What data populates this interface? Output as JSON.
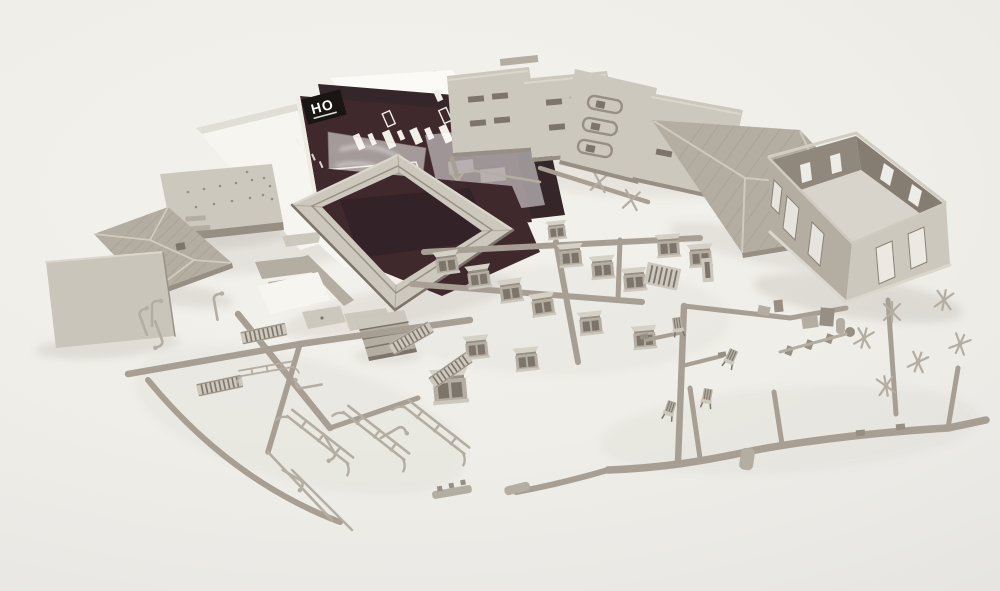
{
  "scene": {
    "type": "product photograph",
    "subject": "Unassembled HO scale model structure kit",
    "description": "Gray styrene plastic parts of an HO scale building kit laid out on a white seamless background: white instruction sheets, dark instruction booklet with HO logo, clear glazing sheet, bag of small parts, four fanned wall panels, large and small hip roof panels, an assembled four-wall building shell, foundation platform with steps, flat base plate, square roof trim frame, and sprues holding windows, doors, ladders, stairs, railings, lamp posts, chairs, chimneys and roof finial details."
  },
  "booklet": {
    "logo_text": "HO"
  },
  "colors": {
    "plastic_light": "#cdc8be",
    "plastic_mid": "#b4ada2",
    "plastic_dark": "#978f83",
    "plastic_deep": "#7d756b",
    "runner": "#a89f94",
    "paper_white": "#f6f5f0",
    "booklet_maroon": "#3f292c",
    "booklet_maroon_light": "#543a3e",
    "logo_black": "#181512",
    "background_top": "#f4f2ec",
    "background_bottom": "#e3e2df",
    "shadow": "#8a847a",
    "bag_amber": "#9b7c55"
  },
  "objects": [
    {
      "id": "paper-stack",
      "label": "White instruction sheets"
    },
    {
      "id": "instruction-booklet",
      "label": "Dark instruction booklet with HO logo and window diagrams"
    },
    {
      "id": "parts-bag",
      "label": "Clear polybag of small parts"
    },
    {
      "id": "glazing-sheet",
      "label": "Clear window glazing sheet"
    },
    {
      "id": "wall-panels",
      "label": "Four molded wall panels with window openings"
    },
    {
      "id": "hip-roof-panel-large",
      "label": "Large hip roof panel"
    },
    {
      "id": "building-shell",
      "label": "Assembled four-wall building shell, open top"
    },
    {
      "id": "base-platform",
      "label": "Foundation platform with molded steps"
    },
    {
      "id": "hip-roof-panel-small",
      "label": "Small hip roof panel"
    },
    {
      "id": "flat-base-plate",
      "label": "Flat rectangular base plate"
    },
    {
      "id": "roof-trim-frame",
      "label": "Square roof trim frame"
    },
    {
      "id": "dark-sheets",
      "label": "Dark cover sheets under the trim frame"
    },
    {
      "id": "window-sprue",
      "label": "Sprue field of window and door castings with awning hoods"
    },
    {
      "id": "ladder-railing-sprue",
      "label": "Sprue of ladders, railings and lamp posts"
    },
    {
      "id": "detail-sprue",
      "label": "Sprue of chimneys, chairs and roof finial details"
    },
    {
      "id": "stairs-block",
      "label": "Molded staircase block"
    },
    {
      "id": "ramp-pieces",
      "label": "Small ramp and trim strips"
    }
  ]
}
